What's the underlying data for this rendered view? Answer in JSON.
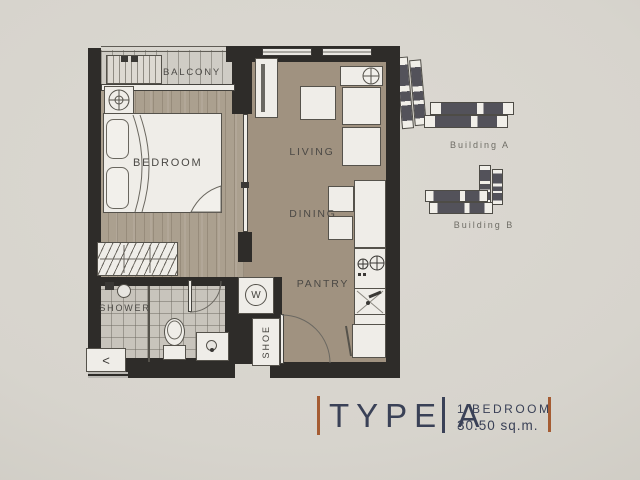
{
  "floorplan": {
    "labels": {
      "balcony": "BALCONY",
      "bedroom": "BEDROOM",
      "living": "LIVING",
      "dining": "DINING",
      "pantry": "PANTRY",
      "shower": "SHOWER",
      "shoe": "SHOE",
      "washer": "W",
      "entry_arrow": "<"
    }
  },
  "site_map": {
    "buildings": [
      {
        "label": "Building A"
      },
      {
        "label": "Building B"
      }
    ]
  },
  "unit_info": {
    "type_label": "TYPE A",
    "bedroom_label": "1 BEDROOM",
    "area_label": "30.50 sq.m."
  },
  "colors": {
    "paper": "#d7d4cd",
    "wall": "#2e2c29",
    "wood_floor": "#9d8f7e",
    "accent_orange": "#a55c33",
    "navy": "#3a4157",
    "building_fill": "#53525a"
  }
}
